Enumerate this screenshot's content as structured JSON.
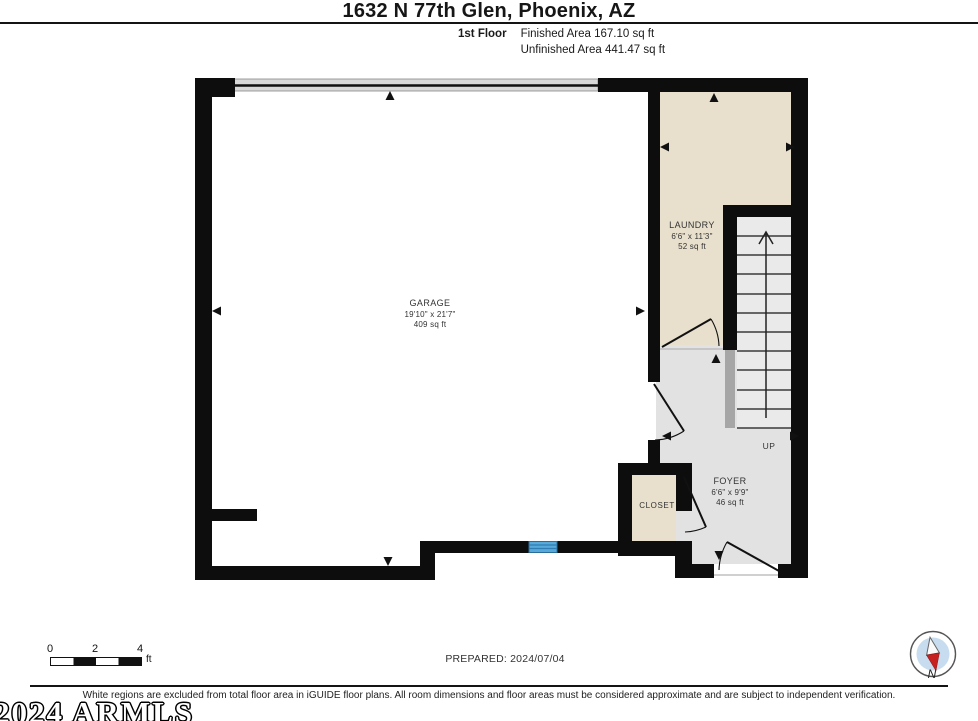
{
  "header": {
    "title": "1632 N 77th Glen, Phoenix, AZ",
    "floor_label": "1st Floor",
    "finished_area": "Finished Area 167.10 sq ft",
    "unfinished_area": "Unfinished Area 441.47 sq ft"
  },
  "rooms": {
    "garage": {
      "name": "GARAGE",
      "dims": "19'10\" x 21'7\"",
      "area": "409 sq ft"
    },
    "laundry": {
      "name": "LAUNDRY",
      "dims": "6'6\" x 11'3\"",
      "area": "52 sq ft"
    },
    "foyer": {
      "name": "FOYER",
      "dims": "6'6\" x 9'9\"",
      "area": "46 sq ft"
    },
    "closet": {
      "name": "CLOSET"
    },
    "stairs": {
      "direction_label": "UP"
    }
  },
  "scale_bar": {
    "ticks": [
      "0",
      "2",
      "4"
    ],
    "unit": "ft"
  },
  "footer": {
    "prepared_label": "PREPARED: 2024/07/04",
    "disclaimer": "White regions are excluded from total floor area in iGUIDE floor plans. All room dimensions and floor areas must be considered approximate and are subject to independent verification.",
    "watermark": "2024 ARMLS",
    "compass_label": "N"
  },
  "colors": {
    "wall": "#0d0d0d",
    "finished_room_fill": "#e8dfcc",
    "circulation_fill": "#e2e2e2",
    "stairs_fill": "#eaeaea",
    "window_blue": "#56a9d8",
    "garage_door_band": "#d9d9d9",
    "compass_inner": "#c7dcee",
    "compass_needle_red": "#c62020"
  }
}
